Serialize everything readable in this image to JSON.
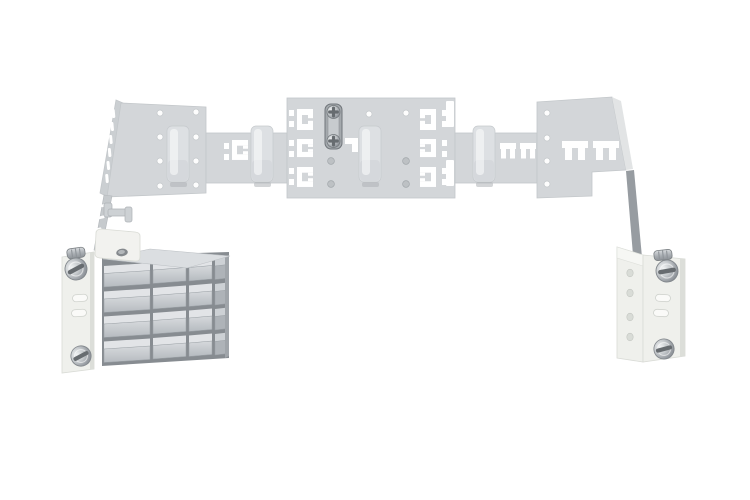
{
  "image": {
    "label": "3D render of a light gray sheet-metal mounting bracket assembly: a wide perforated top plate with snap-in cutouts and rail clips, a metal grounding clamp with two screws, a left support arm holding a small angled plate and a stack of four gray terminal blocks on a slotted fixing bracket with slotted screws, and a right support arm ending in a matching fixing bracket with slotted screws",
    "background": "#ffffff"
  },
  "palette": {
    "background": "#ffffff",
    "plate": "#d3d6d9",
    "plate_edge": "#c3c7ca",
    "flange": "#cbcfd2",
    "cutout": "#ffffff",
    "hole_white": "#fdfdfd",
    "hole_gray": "#bdc1c4",
    "slot_fill": "#fafaf8",
    "clip": "#dde0e3",
    "clamp_metal": "#a4a9ad",
    "screw_slot": "#676c70",
    "arm": "#979ca1",
    "bracket": "#eff0ec",
    "bracket_shadow": "#dcded9",
    "stack_dark": "#878c91",
    "stack_top": "#dbdee1",
    "block_top": "#e2e4e7",
    "block_side": "#aeb3b8",
    "plate_white": "#f2f2ef",
    "oval_dark": "#85898d"
  },
  "parts": {
    "mounting_plate": "perforated mounting plate",
    "rail_clips": "4 rail clips",
    "grounding_clamp": "grounding clamp, 2 cross screws",
    "left_arm": "left support arm",
    "right_arm": "right support arm",
    "left_bracket": "left fixing bracket, 2 slotted screws",
    "right_bracket": "right fixing bracket, 2 slotted screws",
    "terminal_block_stack": "4 rows of gray terminal blocks",
    "angled_plate": "small angled plate with oval hole"
  }
}
